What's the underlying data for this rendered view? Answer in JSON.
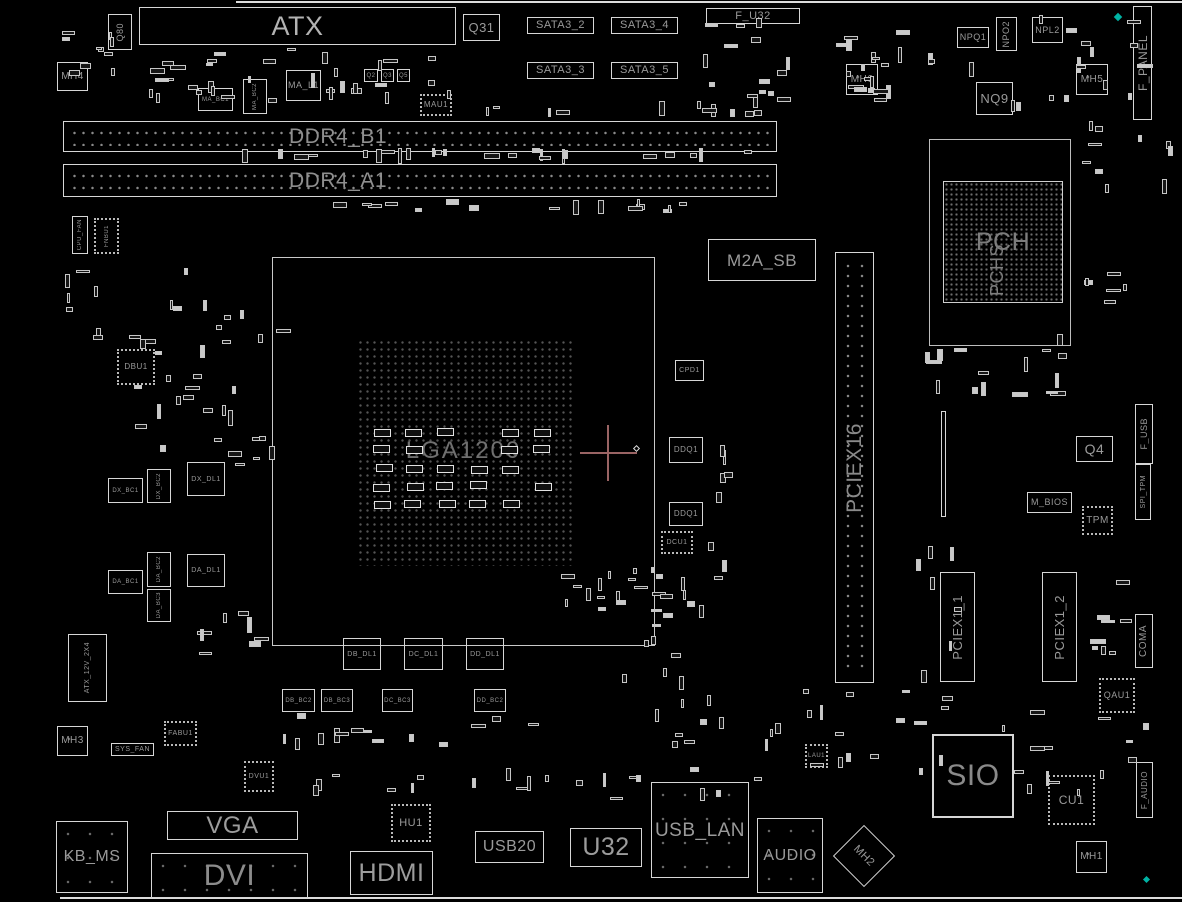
{
  "board": {
    "colors": {
      "background": "#000000",
      "outline": "#d6d6d6",
      "label": "#9a9a9a",
      "crosshair": "#9a6464",
      "teal_marker": "#00b3a4"
    }
  },
  "components": {
    "q80": {
      "label": "Q80"
    },
    "atx": {
      "label": "ATX"
    },
    "q31": {
      "label": "Q31"
    },
    "sata3_2": {
      "label": "SATA3_2"
    },
    "sata3_4": {
      "label": "SATA3_4"
    },
    "sata3_3": {
      "label": "SATA3_3"
    },
    "sata3_5": {
      "label": "SATA3_5"
    },
    "f_u32": {
      "label": "F_U32"
    },
    "npq1": {
      "label": "NPQ1"
    },
    "npo2": {
      "label": "NPO2"
    },
    "npl2": {
      "label": "NPL2"
    },
    "f_panel": {
      "label": "F_PANEL"
    },
    "mh4": {
      "label": "MH4"
    },
    "mh6": {
      "label": "MH6"
    },
    "nq9": {
      "label": "NQ9"
    },
    "mh5": {
      "label": "MH5"
    },
    "ddr4_b1": {
      "label": "DDR4_B1"
    },
    "ddr4_a1": {
      "label": "DDR4_A1"
    },
    "ma_bc1": {
      "label": "MA_BC1"
    },
    "ma_bc2": {
      "label": "MA_BC2"
    },
    "ma_l1": {
      "label": "MA_L1"
    },
    "q2": {
      "label": "Q2"
    },
    "q3": {
      "label": "Q3"
    },
    "q5": {
      "label": "Q5"
    },
    "mau1": {
      "label": "MAU1"
    },
    "pch": {
      "label": "PCH",
      "sublabel": "PCHS"
    },
    "m2a_sb": {
      "label": "M2A_SB"
    },
    "cpu_fan": {
      "label": "CPU_FAN"
    },
    "fnbu1": {
      "label": "FNBU1"
    },
    "dbu1": {
      "label": "DBU1"
    },
    "lga1200": {
      "label": "LGA1200"
    },
    "pciex16": {
      "label": "PCIEX16"
    },
    "cpd1": {
      "label": "CPD1"
    },
    "ddq1_a": {
      "label": "DDQ1"
    },
    "ddq1_b": {
      "label": "DDQ1"
    },
    "dcu1": {
      "label": "DCU1"
    },
    "dx_bc1": {
      "label": "DX_BC1"
    },
    "dx_bc2": {
      "label": "DX_BC2"
    },
    "dx_dl1": {
      "label": "DX_DL1"
    },
    "da_bc1": {
      "label": "DA_BC1"
    },
    "da_bc2": {
      "label": "DA_BC2"
    },
    "da_bc3": {
      "label": "DA_BC3"
    },
    "da_dl1": {
      "label": "DA_DL1"
    },
    "atx_12v_2x4": {
      "label": "ATX_12V_2X4"
    },
    "mh3": {
      "label": "MH3"
    },
    "sys_fan": {
      "label": "SYS_FAN"
    },
    "fabu1": {
      "label": "FABU1"
    },
    "dvu1": {
      "label": "DVU1"
    },
    "db_dl1": {
      "label": "DB_DL1"
    },
    "dc_dl1": {
      "label": "DC_DL1"
    },
    "dd_dl1": {
      "label": "DD_DL1"
    },
    "db_bc2": {
      "label": "DB_BC2"
    },
    "db_bc3": {
      "label": "DB_BC3"
    },
    "dc_bc3": {
      "label": "DC_BC3"
    },
    "dd_bc2": {
      "label": "DD_BC2"
    },
    "kb_ms": {
      "label": "KB_MS"
    },
    "vga": {
      "label": "VGA"
    },
    "dvi": {
      "label": "DVI"
    },
    "hdmi": {
      "label": "HDMI"
    },
    "hu1": {
      "label": "HU1"
    },
    "usb20": {
      "label": "USB20"
    },
    "u32": {
      "label": "U32"
    },
    "usb_lan": {
      "label": "USB_LAN"
    },
    "audio": {
      "label": "AUDIO"
    },
    "mh2": {
      "label": "MH2"
    },
    "sio": {
      "label": "SIO"
    },
    "cu1": {
      "label": "CU1"
    },
    "mh1": {
      "label": "MH1"
    },
    "f_audio": {
      "label": "F_AUDIO"
    },
    "lau1": {
      "label": "LAU1"
    },
    "q4": {
      "label": "Q4"
    },
    "f_usb": {
      "label": "F_USB"
    },
    "m_bios": {
      "label": "M_BIOS"
    },
    "tpm": {
      "label": "TPM"
    },
    "spi_tpm": {
      "label": "SPI_TPM"
    },
    "pciex1_1": {
      "label": "PCIEX1_1"
    },
    "pciex1_2": {
      "label": "PCIEX1_2"
    },
    "coma": {
      "label": "COMA"
    },
    "qau1": {
      "label": "QAU1"
    }
  }
}
